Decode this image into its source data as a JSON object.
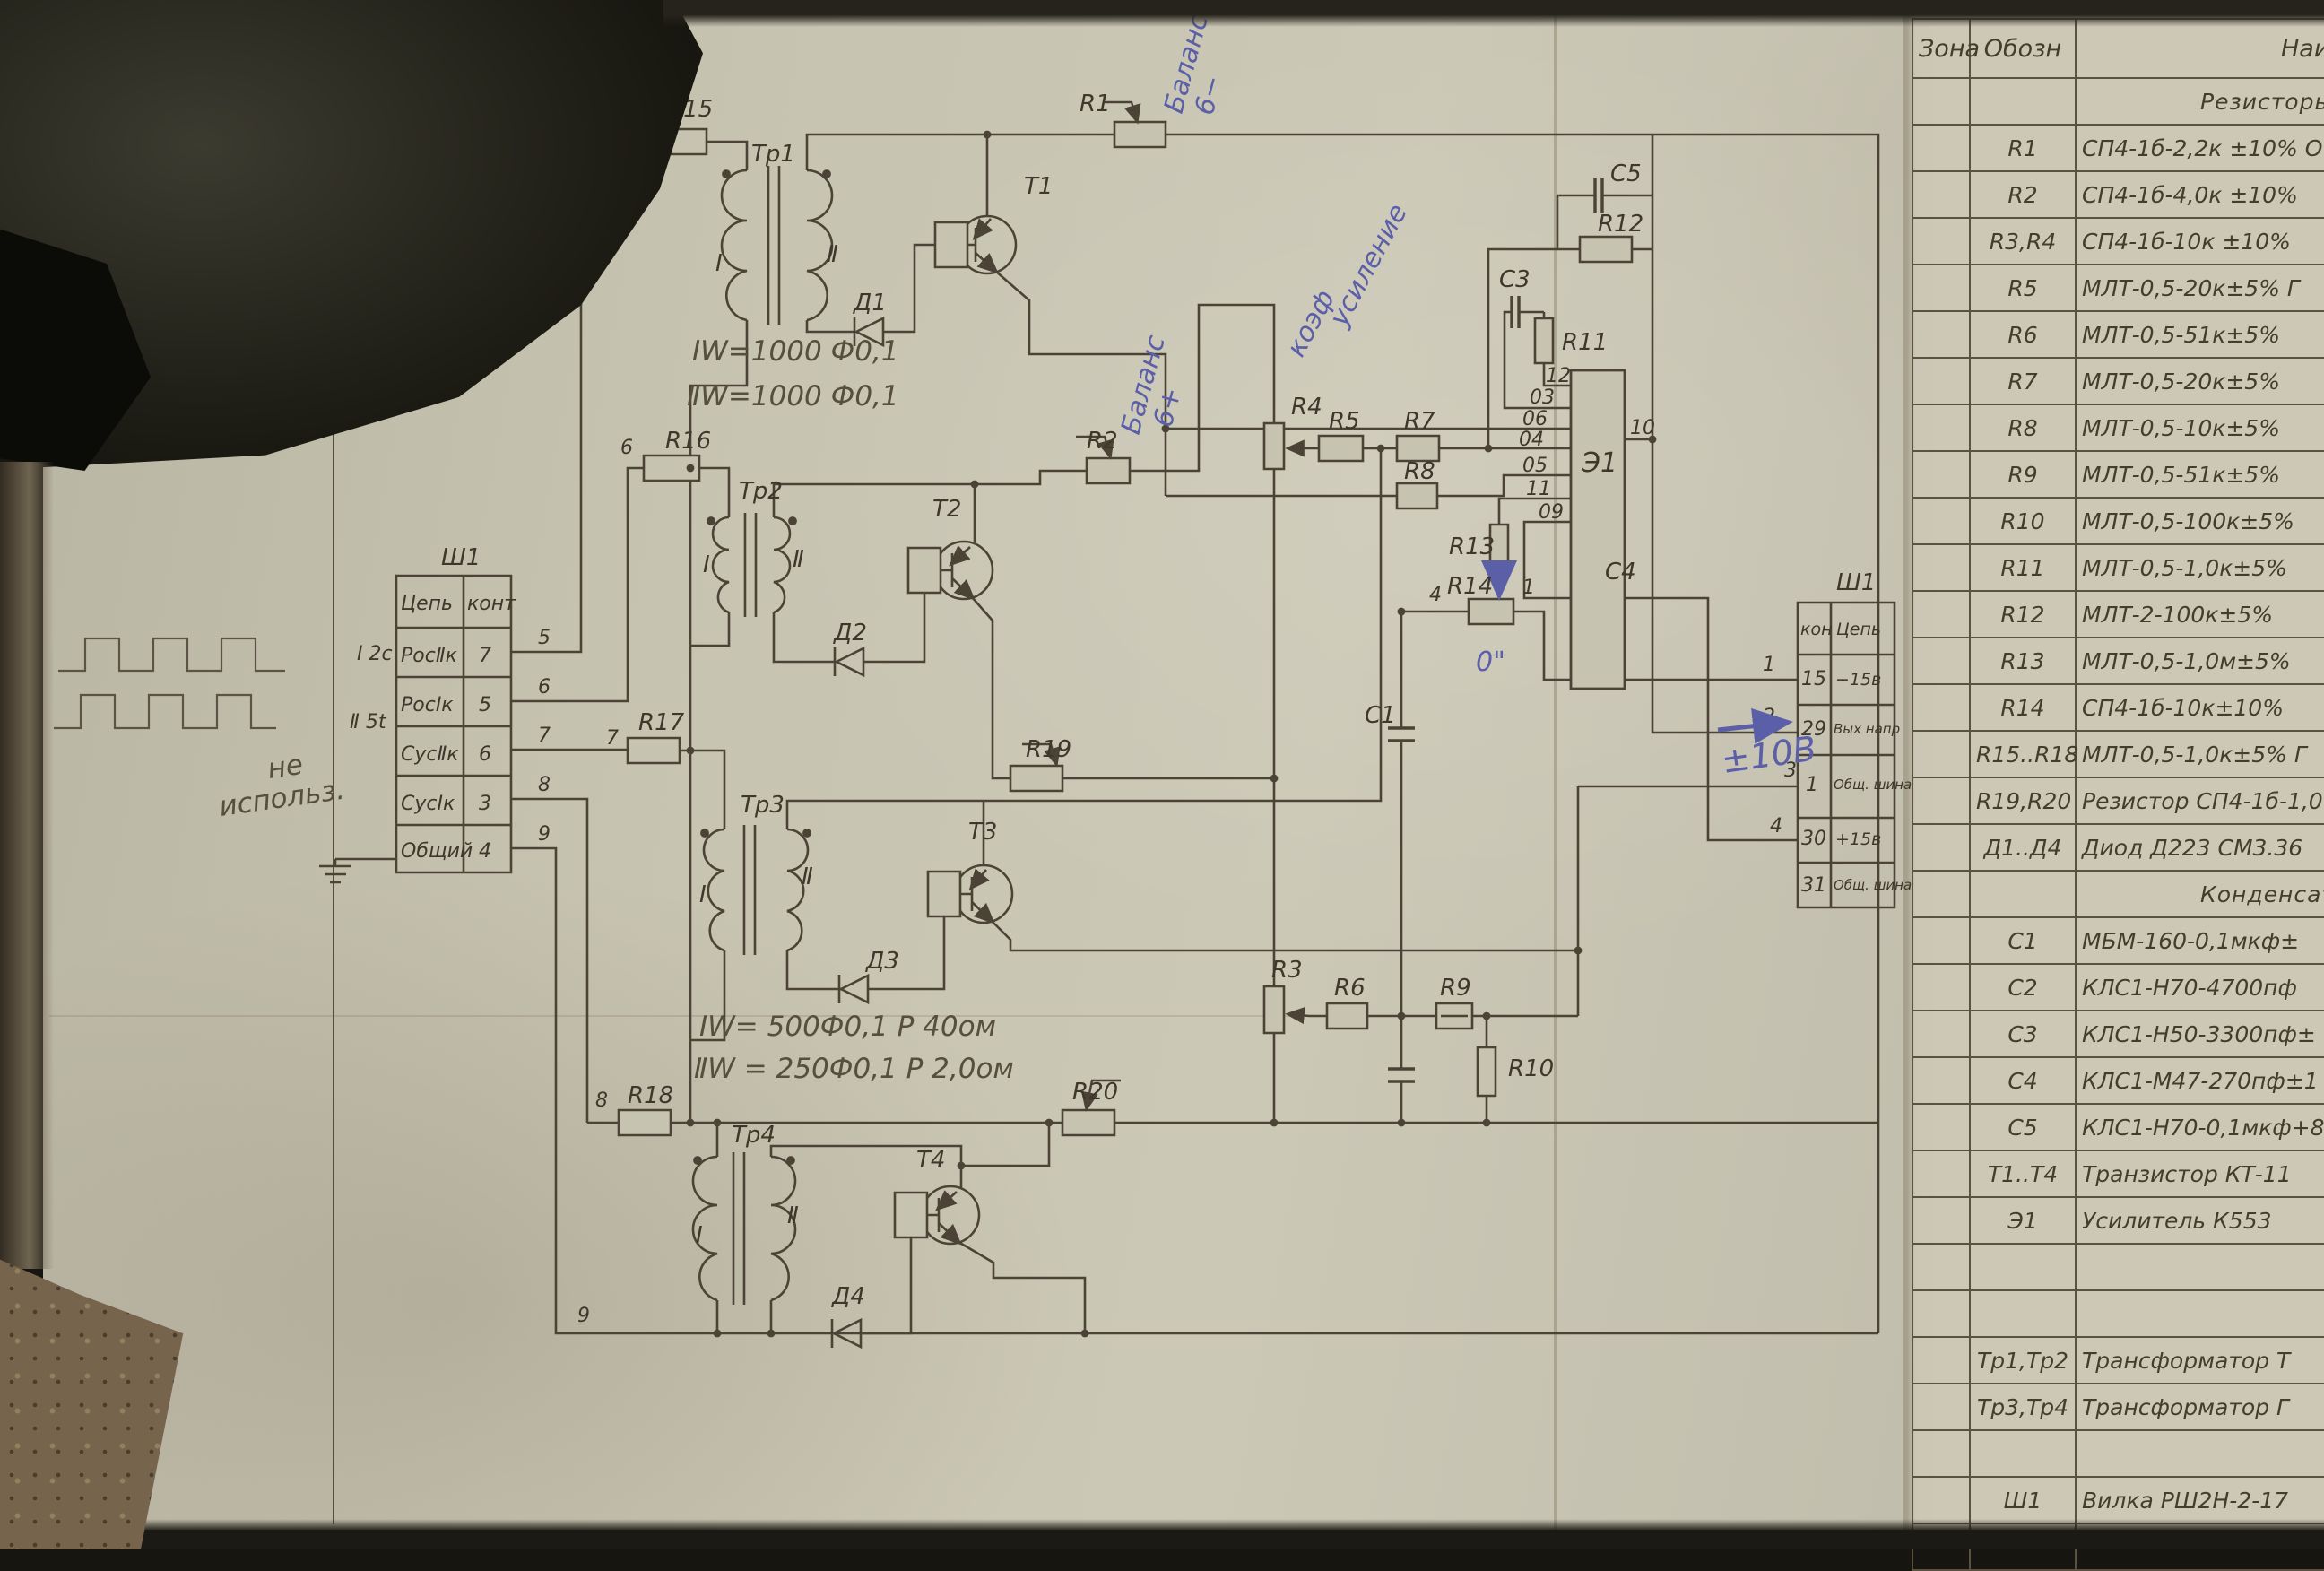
{
  "colors": {
    "ink": "#4a4336",
    "pencil_note": "#564f3c",
    "blue_pencil": "#5b5fa8",
    "paper": "#c7c3b1"
  },
  "schematic": {
    "labels": {
      "r1": "R1",
      "r2": "R2",
      "r3": "R3",
      "r4": "R4",
      "r5": "R5",
      "r6": "R6",
      "r7": "R7",
      "r8": "R8",
      "r9": "R9",
      "r10": "R10",
      "r11": "R11",
      "r12": "R12",
      "r13": "R13",
      "r14": "R14",
      "r15": "R15",
      "r16": "R16",
      "r17": "R17",
      "r18": "R18",
      "r19": "R19",
      "r20": "R20",
      "c1": "С1",
      "c3": "С3",
      "c4": "С4",
      "c5": "С5",
      "d1": "Д1",
      "d2": "Д2",
      "d3": "Д3",
      "d4": "Д4",
      "t1": "Т1",
      "t2": "Т2",
      "t3": "Т3",
      "t4": "Т4",
      "tr1": "Тр1",
      "tr2": "Тр2",
      "tr3": "Тр3",
      "tr4": "Тр4",
      "e1": "Э1",
      "winding_i": "Ⅰ",
      "winding_ii": "Ⅱ"
    },
    "pins": {
      "p12": "12",
      "p03": "03",
      "p06": "06",
      "p04": "04",
      "p05": "05",
      "p11": "11",
      "p09": "09",
      "p10": "10"
    },
    "wires": {
      "w5": "5",
      "w6": "6",
      "w7": "7",
      "w8": "8",
      "w9": "9",
      "w5b": "5",
      "w6b": "6",
      "w7b": "7",
      "w8b": "8",
      "w9b": "9",
      "n1": "1",
      "n2": "2",
      "n3": "3",
      "n4": "4",
      "n4b": "4",
      "n1b": "1"
    },
    "annotations": {
      "tr1_w1": "ⅠW=1000 Ф0,1",
      "tr1_w2": "ⅡW=1000 Ф0,1",
      "tr3_w1": "ⅠW= 500Ф0,1  Р 40ом",
      "tr3_w2": "ⅡW = 250Ф0,1  Р 2,0ом",
      "balance1": "Баланс",
      "balance1_sign": "6−",
      "balance2": "Баланс",
      "balance2_sign": "6+",
      "gain1": "коэф",
      "gain2": "усиление",
      "zero": "0\"",
      "out": "±10В",
      "not_used_1": "не",
      "not_used_2": "использ.",
      "wave1": "Ⅰ 2с",
      "wave2": "Ⅱ 5t"
    }
  },
  "connector_left": {
    "title": "Ш1",
    "col_circuit": "Цепь",
    "col_contact": "конт",
    "rows": [
      {
        "circuit": "РосⅡк",
        "contact": "7"
      },
      {
        "circuit": "РосⅠк",
        "contact": "5"
      },
      {
        "circuit": "СусⅡк",
        "contact": "6"
      },
      {
        "circuit": "СусⅠк",
        "contact": "3"
      },
      {
        "circuit": "Общий",
        "contact": "4"
      }
    ]
  },
  "connector_right": {
    "title": "Ш1",
    "col_contact": "кон",
    "col_circuit": "Цепь",
    "rows": [
      {
        "contact": "15",
        "circuit": "−15в"
      },
      {
        "contact": "29",
        "circuit": "Вых напр"
      },
      {
        "contact": "1",
        "circuit": "Общ. шина"
      },
      {
        "contact": "30",
        "circuit": "+15в"
      },
      {
        "contact": "31",
        "circuit": "Общ. шина"
      }
    ]
  },
  "parts": {
    "headers": {
      "zone": "Зона",
      "ref": "Обозн",
      "name": "Наименование"
    },
    "rows": [
      {
        "ref": "",
        "name": "Резисторы",
        "section": true
      },
      {
        "ref": "R1",
        "name": "СП4-1б-2,2к ±10%      О"
      },
      {
        "ref": "R2",
        "name": "СП4-1б-4,0к ±10%"
      },
      {
        "ref": "R3,R4",
        "name": "СП4-1б-10к ±10%"
      },
      {
        "ref": "R5",
        "name": "МЛТ-0,5-20к±5%   Г"
      },
      {
        "ref": "R6",
        "name": "МЛТ-0,5-51к±5%"
      },
      {
        "ref": "R7",
        "name": "МЛТ-0,5-20к±5%"
      },
      {
        "ref": "R8",
        "name": "МЛТ-0,5-10к±5%"
      },
      {
        "ref": "R9",
        "name": "МЛТ-0,5-51к±5%"
      },
      {
        "ref": "R10",
        "name": "МЛТ-0,5-100к±5%"
      },
      {
        "ref": "R11",
        "name": "МЛТ-0,5-1,0к±5%"
      },
      {
        "ref": "R12",
        "name": "МЛТ-2-100к±5%"
      },
      {
        "ref": "R13",
        "name": "МЛТ-0,5-1,0м±5%"
      },
      {
        "ref": "R14",
        "name": "СП4-1б-10к±10%"
      },
      {
        "ref": "R15..R18",
        "name": "МЛТ-0,5-1,0к±5%  Г"
      },
      {
        "ref": "R19,R20",
        "name": "Резистор СП4-1б-1,0"
      },
      {
        "ref": "Д1..Д4",
        "name": "Диод Д223 СМ3.36"
      },
      {
        "ref": "",
        "name": "Конденсаторы",
        "section": true
      },
      {
        "ref": "С1",
        "name": "МБМ-160-0,1мкф±"
      },
      {
        "ref": "С2",
        "name": "КЛС1-Н70-4700пф"
      },
      {
        "ref": "С3",
        "name": "КЛС1-Н50-3300пф±"
      },
      {
        "ref": "С4",
        "name": "КЛС1-М47-270пф±1"
      },
      {
        "ref": "С5",
        "name": "КЛС1-Н70-0,1мкф+8−2"
      },
      {
        "ref": "Т1..Т4",
        "name": "Транзистор КТ-11"
      },
      {
        "ref": "Э1",
        "name": "Усилитель  К553"
      },
      {
        "ref": "",
        "name": ""
      },
      {
        "ref": "",
        "name": ""
      },
      {
        "ref": "Тр1,Тр2",
        "name": "Трансформатор Т"
      },
      {
        "ref": "Тр3,Тр4",
        "name": "Трансформатор Г"
      },
      {
        "ref": "",
        "name": ""
      },
      {
        "ref": "Ш1",
        "name": "Вилка РШ2Н-2-17"
      },
      {
        "ref": "",
        "name": ""
      }
    ]
  }
}
